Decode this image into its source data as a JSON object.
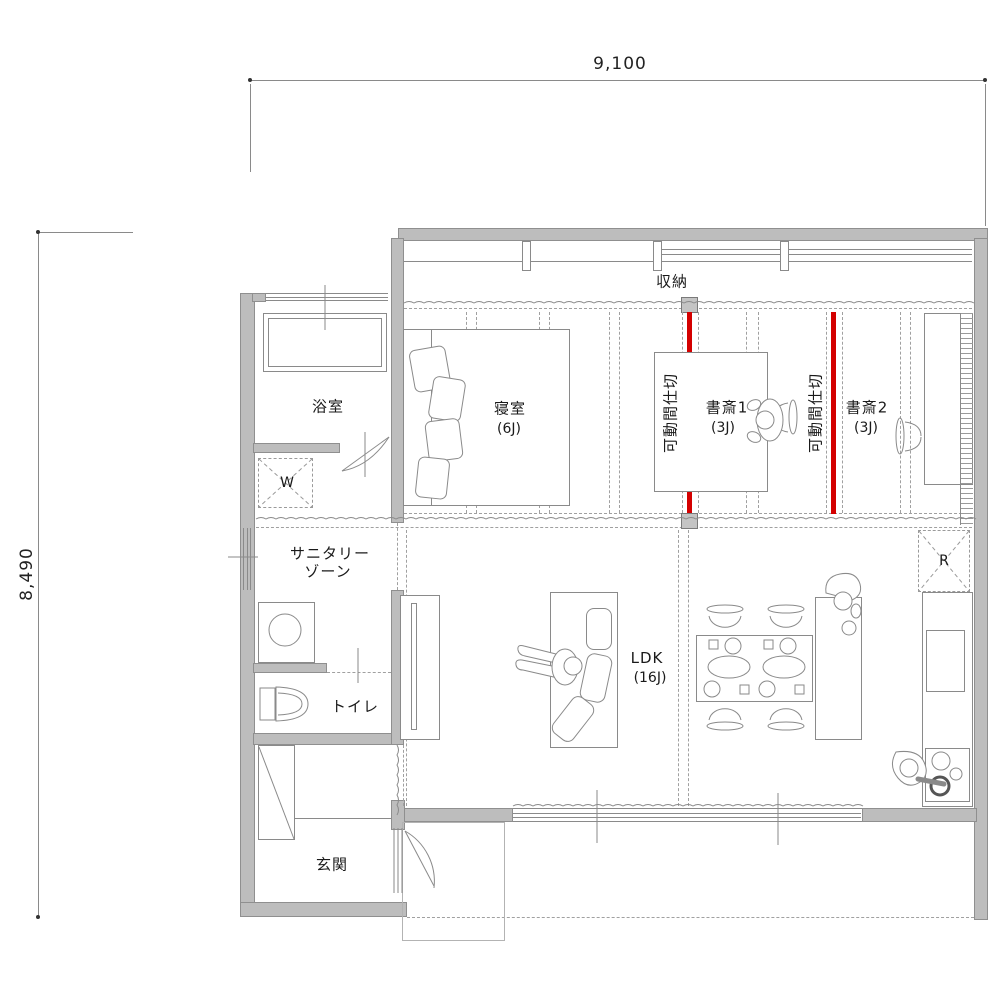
{
  "title": "apartment-floor-plan",
  "dimensions": {
    "width_label": "9,100",
    "height_label": "8,490"
  },
  "rooms": {
    "storage": {
      "label": "収納"
    },
    "bedroom": {
      "label": "寝室",
      "size": "(6J)"
    },
    "study1": {
      "label": "書斎1",
      "size": "(3J)"
    },
    "study2": {
      "label": "書斎2",
      "size": "(3J)"
    },
    "ldk": {
      "label": "LDK",
      "size": "(16J)"
    },
    "bathroom": {
      "label": "浴室"
    },
    "sanitary": {
      "label_line1": "サニタリー",
      "label_line2": "ゾーン"
    },
    "toilet": {
      "label": "トイレ"
    },
    "entrance": {
      "label": "玄関"
    }
  },
  "partitions": {
    "label": "可動間仕切",
    "color": "#d40000"
  },
  "appliances": {
    "washer_label": "W",
    "fridge_label": "R"
  },
  "colors": {
    "wall_fill": "#bdbdbd",
    "wall_border": "#8f8f8f",
    "furniture_line": "#8a8a8a",
    "dashed_line": "#a0a0a0",
    "partition_red": "#d40000",
    "text": "#1a1a1a"
  }
}
